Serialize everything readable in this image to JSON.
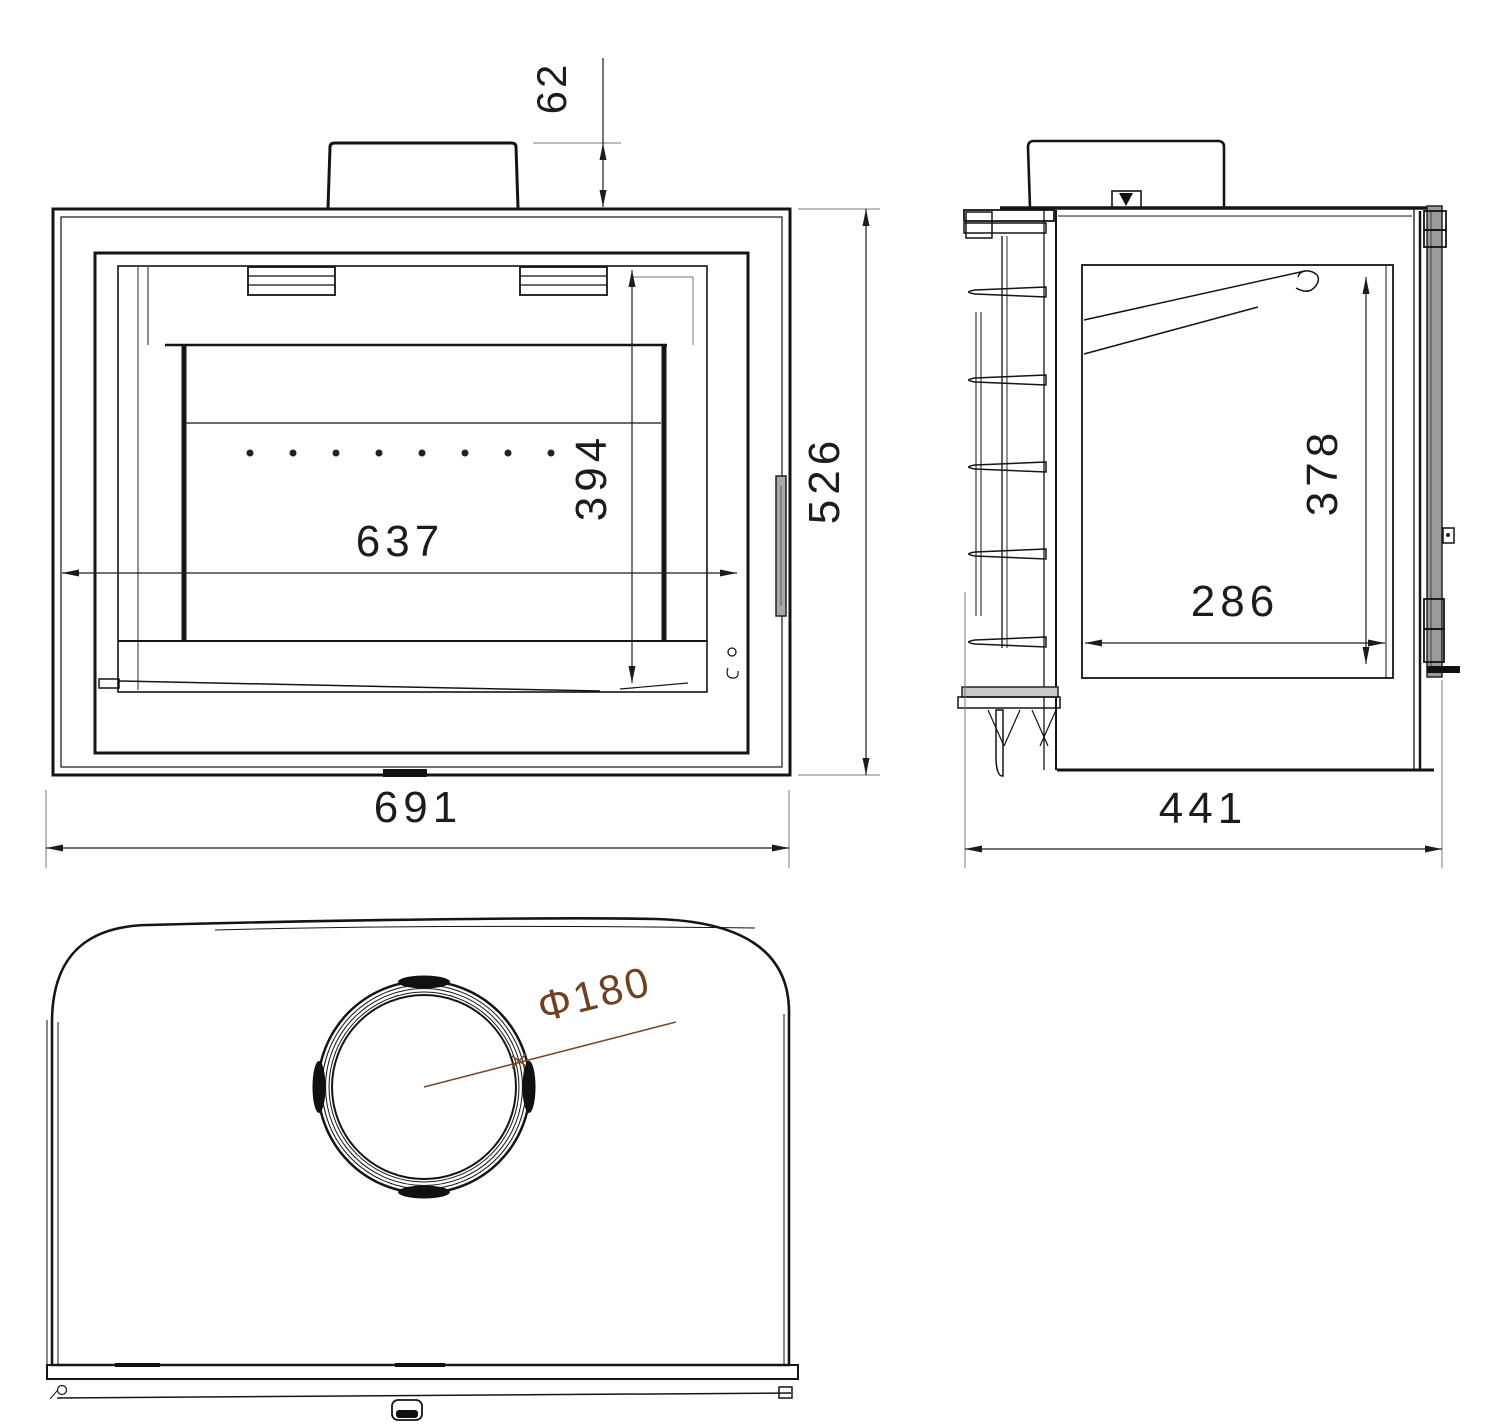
{
  "drawing": {
    "kind": "fireplace-insert dimensional drawing, three orthographic views",
    "colors": {
      "line": "#141414",
      "extension_line": "#777777",
      "handle_gray": "#a8a8a8",
      "accent_brown": "#6f4122"
    },
    "dims": {
      "front": {
        "collar_height": "62",
        "overall_height": "526",
        "overall_width": "691",
        "glass_width": "637",
        "glass_height": "394"
      },
      "side": {
        "firebox_height": "378",
        "firebox_depth": "286",
        "overall_depth": "441"
      },
      "top": {
        "flue_diameter": "Φ180"
      }
    }
  }
}
